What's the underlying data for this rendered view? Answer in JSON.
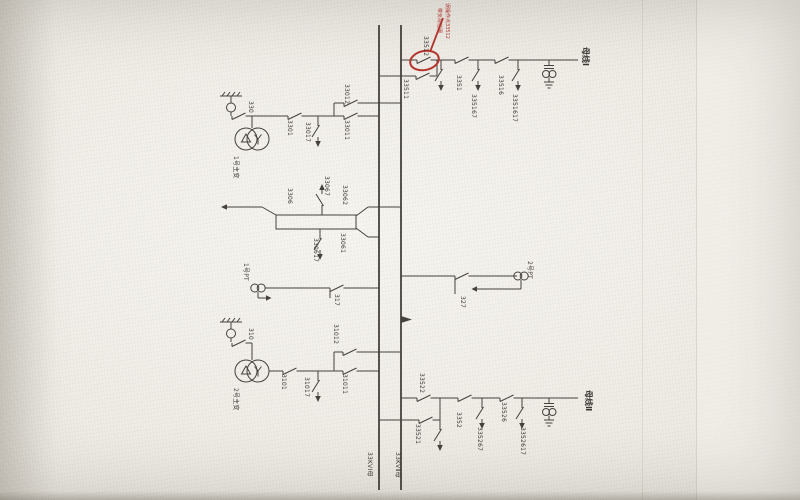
{
  "annotation": {
    "line1": "误操作点33512",
    "line2": "带负荷拉闸"
  },
  "buses": {
    "bus1": "33KVⅠ母",
    "bus2": "33KVⅡ母"
  },
  "feeder1": {
    "line_name": "母线Ⅰ",
    "qs_bus2": "33512",
    "qs_bus1": "33511",
    "qs_line": "3351",
    "es1": "335167",
    "qs2": "33516",
    "es2": "3351617"
  },
  "transformer1": {
    "name": "1号主变",
    "arrester_qs": "330",
    "qs": "3301",
    "es": "33017",
    "qs_bus1": "33011",
    "qs_bus2": "33012"
  },
  "section": {
    "qs_left": "3306",
    "es_top": "33067",
    "qs_bus2": "33062",
    "qs_bus1": "33061",
    "es_bottom": "330617"
  },
  "pt1": {
    "name": "1号PT",
    "qs": "317"
  },
  "pt2": {
    "name": "2号PT",
    "qs": "327"
  },
  "transformer2": {
    "name": "2号主变",
    "arrester_qs": "310",
    "qs": "3101",
    "es": "31017",
    "qs_bus1": "31011",
    "qs_bus2": "31012"
  },
  "feeder2": {
    "line_name": "母线Ⅱ",
    "qs_bus2": "33522",
    "qs_bus1": "33521",
    "qs_line": "3352",
    "es1": "335267",
    "qs2": "33526",
    "es2": "3352617"
  },
  "colors": {
    "wire": "#45423d",
    "annotation": "#b5342c",
    "paper": "#efece7"
  }
}
